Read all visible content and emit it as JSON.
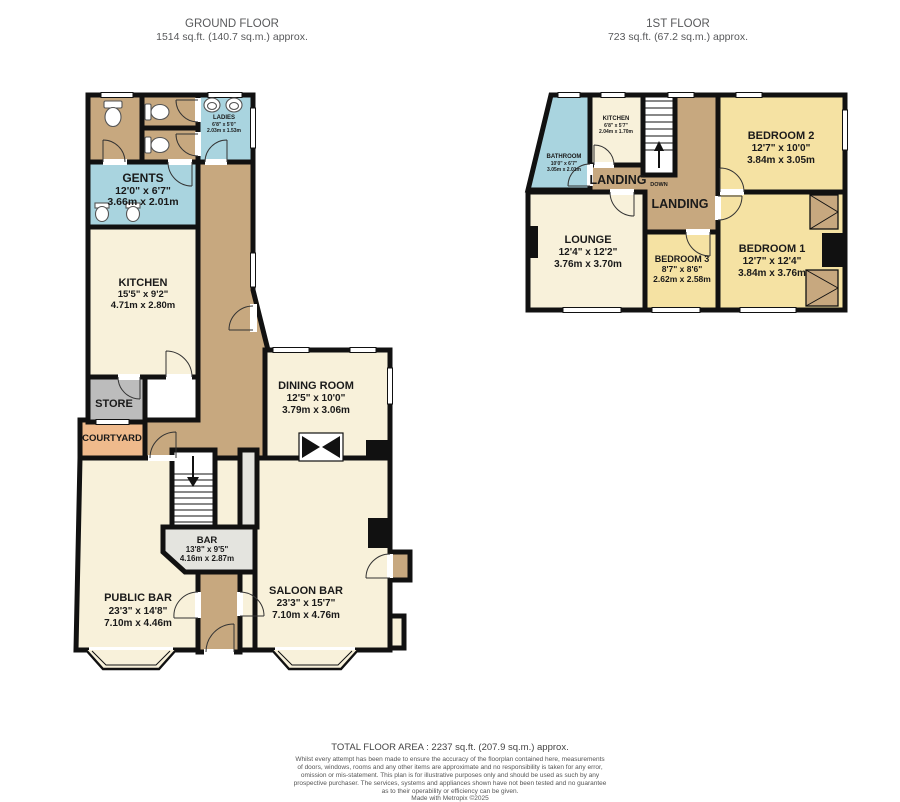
{
  "titles": {
    "ground": {
      "name": "GROUND FLOOR",
      "area": "1514 sq.ft. (140.7 sq.m.) approx."
    },
    "first": {
      "name": "1ST FLOOR",
      "area": "723 sq.ft. (67.2 sq.m.) approx."
    }
  },
  "rooms": {
    "gents": {
      "name": "GENTS",
      "imperial": "12'0\" x 6'7\"",
      "metric": "3.66m x 2.01m"
    },
    "ladies": {
      "name": "LADIES",
      "imperial": "6'8\" x 5'0\"",
      "metric": "2.03m x 1.53m"
    },
    "kitchen_g": {
      "name": "KITCHEN",
      "imperial": "15'5\" x 9'2\"",
      "metric": "4.71m x 2.80m"
    },
    "store": {
      "name": "STORE"
    },
    "courtyard": {
      "name": "COURTYARD"
    },
    "dining": {
      "name": "DINING ROOM",
      "imperial": "12'5\" x 10'0\"",
      "metric": "3.79m x 3.06m"
    },
    "bar": {
      "name": "BAR",
      "imperial": "13'8\" x 9'5\"",
      "metric": "4.16m x 2.87m"
    },
    "public_bar": {
      "name": "PUBLIC BAR",
      "imperial": "23'3\" x 14'8\"",
      "metric": "7.10m x 4.46m"
    },
    "saloon_bar": {
      "name": "SALOON BAR",
      "imperial": "23'3\" x 15'7\"",
      "metric": "7.10m x 4.76m"
    },
    "bathroom": {
      "name": "BATHROOM",
      "imperial": "10'0\" x 6'7\"",
      "metric": "3.05m x 2.01m"
    },
    "kitchen_1": {
      "name": "KITCHEN",
      "imperial": "6'8\" x 5'7\"",
      "metric": "2.04m x 1.70m"
    },
    "landing_1": {
      "name": "LANDING"
    },
    "landing_2": {
      "name": "LANDING"
    },
    "lounge": {
      "name": "LOUNGE",
      "imperial": "12'4\" x 12'2\"",
      "metric": "3.76m x 3.70m"
    },
    "bedroom_1": {
      "name": "BEDROOM 1",
      "imperial": "12'7\" x 12'4\"",
      "metric": "3.84m x 3.76m"
    },
    "bedroom_2": {
      "name": "BEDROOM 2",
      "imperial": "12'7\" x 10'0\"",
      "metric": "3.84m x 3.05m"
    },
    "bedroom_3": {
      "name": "BEDROOM 3",
      "imperial": "8'7\" x 8'6\"",
      "metric": "2.62m x 2.58m"
    }
  },
  "stairs": {
    "down": "DOWN"
  },
  "footer": {
    "total": "TOTAL FLOOR AREA : 2237 sq.ft. (207.9 sq.m.) approx.",
    "lines": [
      "Whilst every attempt has been made to ensure the accuracy of the floorplan contained here, measurements",
      "of doors, windows, rooms and any other items are approximate and no responsibility is taken for any error,",
      "omission or mis-statement. This plan is for illustrative purposes only and should be used as such by any",
      "prospective purchaser. The services, systems and appliances shown have not been tested and no guarantee",
      "as to their operability or efficiency can be given."
    ],
    "credit": "Made with Metropix ©2025"
  },
  "colors": {
    "wall": "#111111",
    "cream": "#f8f1da",
    "yellow": "#f5e2a3",
    "blue": "#a9d4df",
    "tan": "#c7a87f",
    "gray": "#bcbcbc",
    "bar_gray": "#e4e4df",
    "peach": "#efba8c"
  }
}
